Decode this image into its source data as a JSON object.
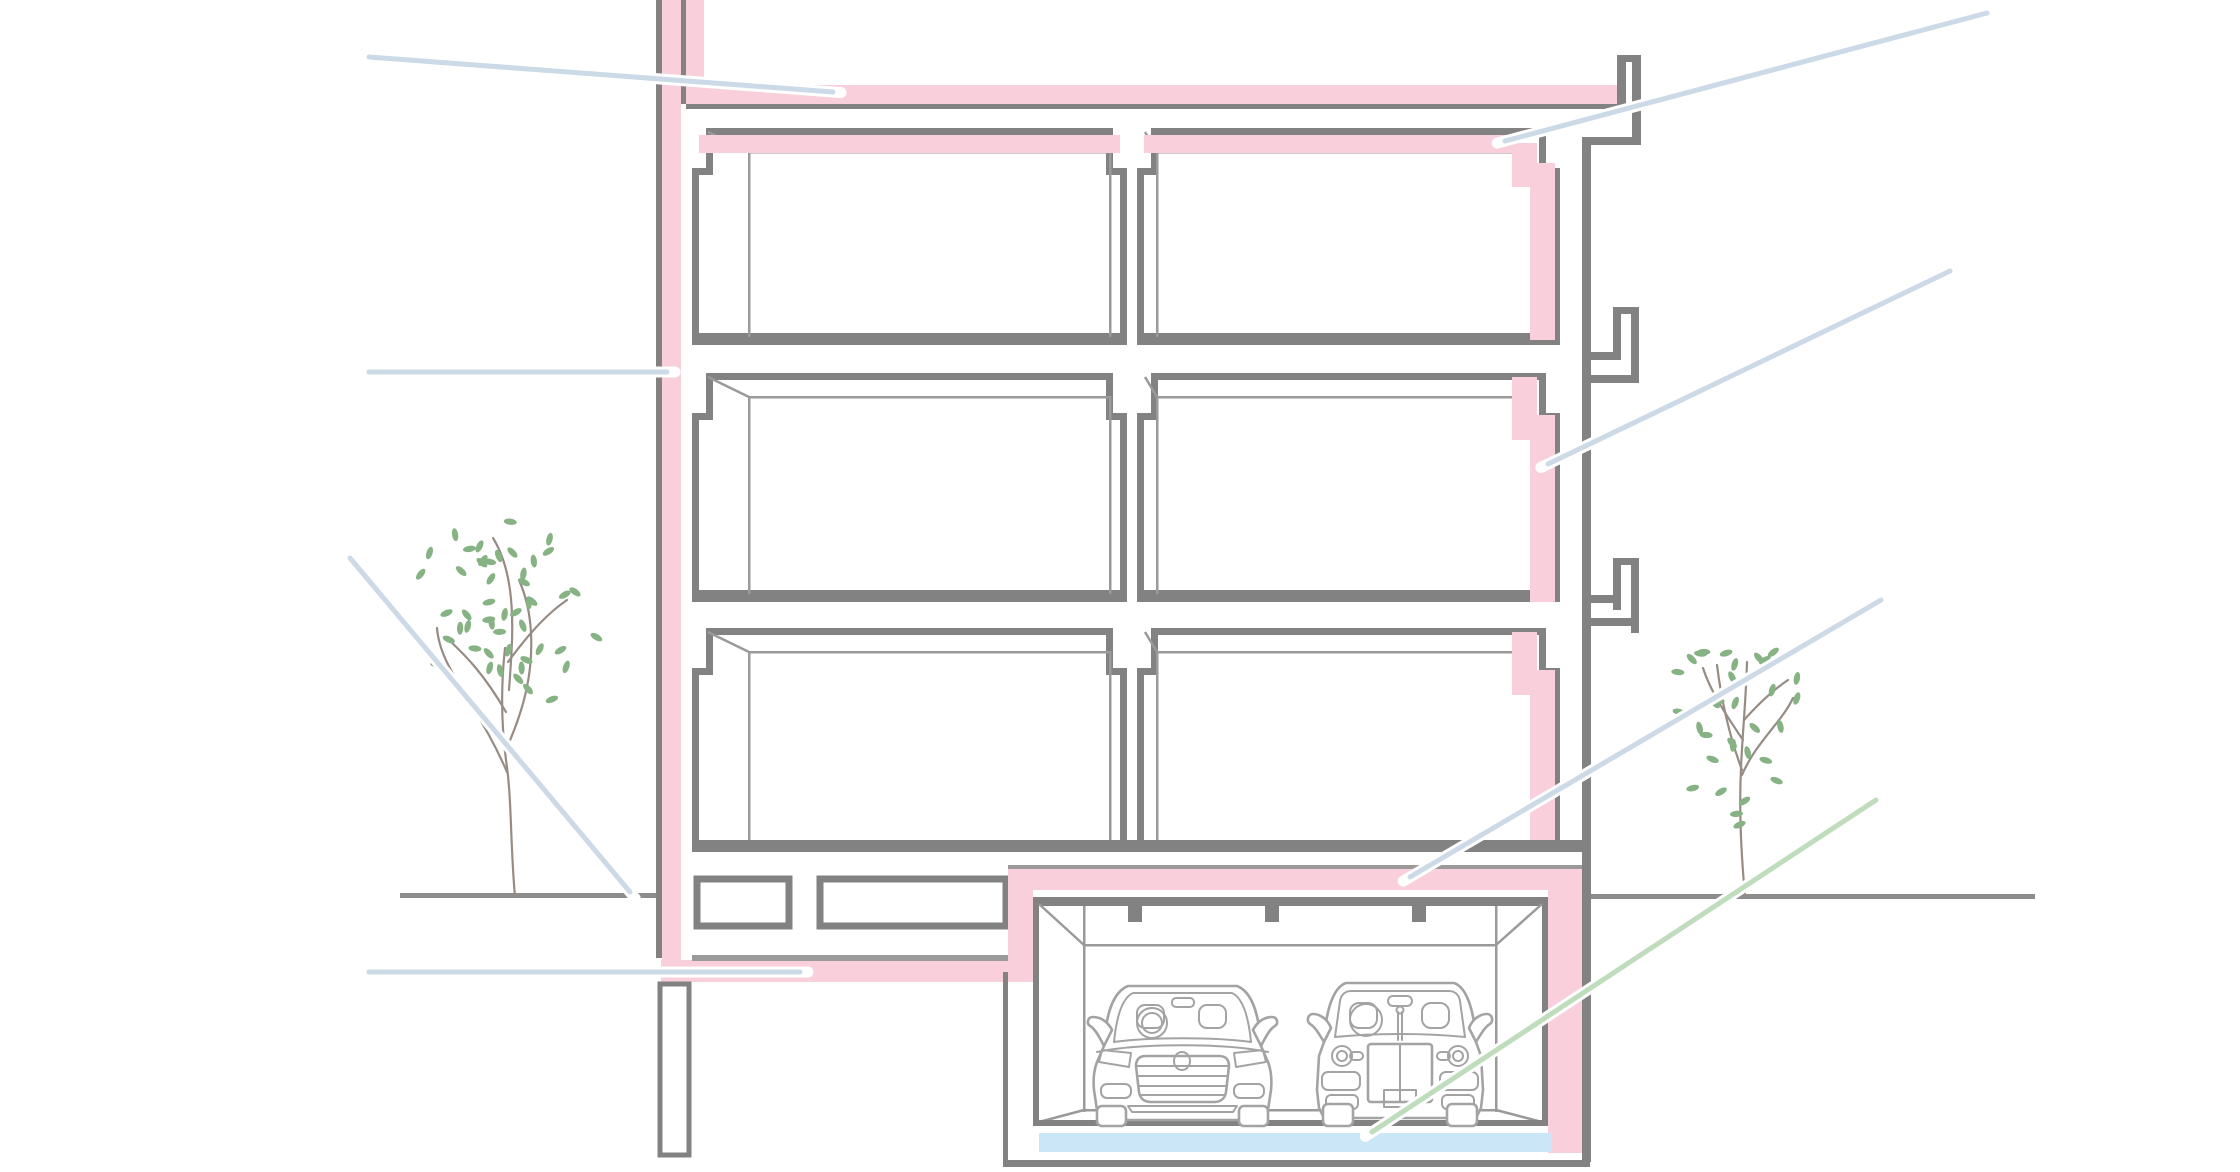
{
  "colors": {
    "bg": "#ffffff",
    "pink": "#f8cfda",
    "blue": "#cbe6f7",
    "gray": "#828282",
    "thin": "#9a9a9a",
    "callout": "#ccd9e6",
    "callout-green": "#bfdcbd",
    "leaf": "#86b284",
    "branch": "#968c84",
    "car": "#a3a3a3",
    "ground": "#8c8c8c"
  },
  "diagram": {
    "type": "building-cross-section",
    "floors_above_ground": 3,
    "rooms_per_floor": 2,
    "basement": "parking-garage",
    "cars_in_garage": 2,
    "trees": 2,
    "highlighted_elements": {
      "insulation_color_key": "pink",
      "garage_floor_slab_color_key": "blue",
      "insulated_parts": [
        "left-exterior-wall",
        "roof-parapet",
        "roof-slab",
        "top-floor-ceiling",
        "right-wall-per-floor",
        "basement-perimeter",
        "garage-ceiling",
        "garage-right-wall"
      ]
    },
    "callouts": [
      {
        "id": "roof-slab-insulation",
        "color_key": "callout"
      },
      {
        "id": "top-ceiling-insulation-right",
        "color_key": "callout"
      },
      {
        "id": "right-wall-insulation",
        "color_key": "callout"
      },
      {
        "id": "left-wall-insulation",
        "color_key": "callout"
      },
      {
        "id": "ground-level-at-wall-base",
        "color_key": "callout"
      },
      {
        "id": "basement-ceiling-insulation-left",
        "color_key": "callout"
      },
      {
        "id": "garage-ceiling-insulation",
        "color_key": "callout"
      },
      {
        "id": "garage-floor-slab",
        "color_key": "callout-green"
      }
    ]
  }
}
